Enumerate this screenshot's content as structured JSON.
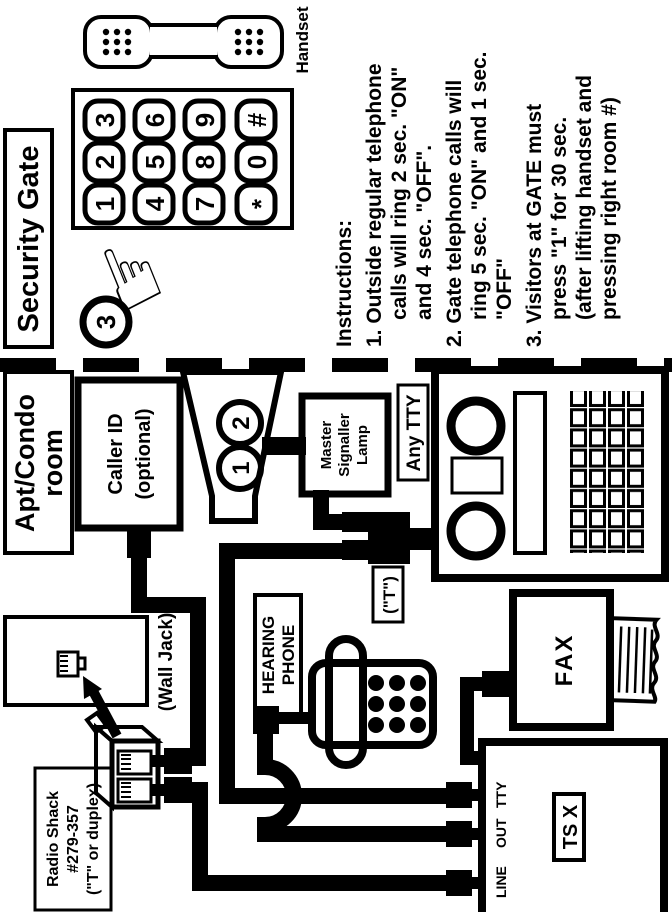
{
  "colors": {
    "ink": "#000000",
    "paper": "#ffffff"
  },
  "security_gate": {
    "title": "Security Gate",
    "handset_label": "Handset",
    "callout_number": "3",
    "pressed_key": "1",
    "keypad": [
      "1",
      "2",
      "3",
      "4",
      "5",
      "6",
      "7",
      "8",
      "9",
      "*",
      "0",
      "#"
    ],
    "instructions": {
      "heading": "Instructions:",
      "lines": [
        "1. Outside regular telephone",
        "calls will ring 2 sec. \"ON\"",
        "and 4 sec. \"OFF\".",
        "2. Gate telephone calls will",
        "ring 5 sec. \"ON\" and 1 sec.",
        "\"OFF\"",
        "3. Visitors at GATE must",
        "press \"1\" for 30 sec.",
        "(after lifting handset and",
        "pressing right room #)"
      ]
    }
  },
  "apt_condo": {
    "title_lines": [
      "Apt/Condo",
      "room"
    ],
    "caller_id_lines": [
      "Caller ID",
      "(optional)"
    ],
    "ringer_numbers": [
      "1",
      "2"
    ],
    "master_lamp_lines": [
      "Master",
      "Signaller",
      "Lamp"
    ],
    "any_tty_label": "Any TTY",
    "wall_jack_label": "(Wall Jack)",
    "radio_shack_lines": [
      "Radio Shack",
      "#279-357",
      "(\"T\" or duplex)"
    ],
    "hearing_phone_lines": [
      "HEARING",
      "PHONE"
    ],
    "t_adapter_label": "(\"T\")",
    "fax_label": "FAX",
    "tsx_label": "TS X",
    "port_labels": [
      "LINE",
      "OUT",
      "TTY"
    ]
  }
}
